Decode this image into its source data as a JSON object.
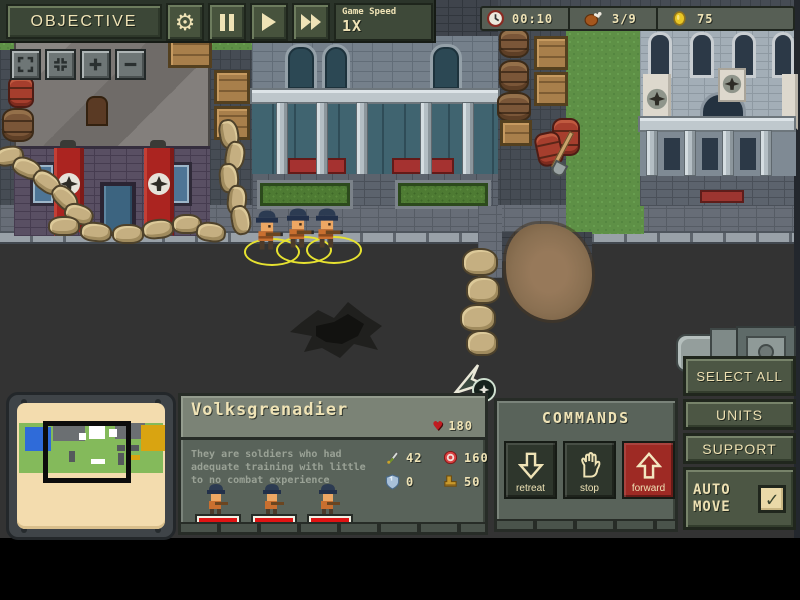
{
  "hud": {
    "objective": "OBJECTIVE",
    "game_speed_label": "Game Speed",
    "game_speed_value": "1X",
    "timer": "00:10",
    "food": "3/9",
    "coins": "75"
  },
  "camera_controls": {
    "icons": [
      "expand-icon",
      "shrink-icon",
      "zoom-in-icon",
      "zoom-out-icon"
    ]
  },
  "unit_panel": {
    "title": "Volksgrenadier",
    "hp": "180",
    "description": "They are soldiers who had adequate training with little to no combat experience",
    "attack": "42",
    "range": "160",
    "armor": "0",
    "speed": "50",
    "unit_count": 3
  },
  "commands": {
    "title": "COMMANDS",
    "retreat": "retreat",
    "stop": "stop",
    "forward": "forward"
  },
  "side": {
    "select_all": "SELECT ALL",
    "units": "UNITS",
    "support": "SUPPORT",
    "auto_move": "AUTO MOVE",
    "auto_move_checked": true,
    "check_glyph": "✓"
  },
  "icons": {
    "settings": "gear-icon",
    "pause": "pause-icon",
    "play": "play-icon",
    "fast_forward": "fast-forward-icon",
    "timer": "clock-icon",
    "food": "drumstick-icon",
    "money": "coin-icon",
    "hp": "heart-icon",
    "attack": "sword-icon",
    "range": "target-icon",
    "armor": "shield-icon",
    "speed": "boot-icon"
  },
  "colors": {
    "cream_text": "#efe3b6",
    "olive_button": "#47533d",
    "panel": "#59635a",
    "banner_red": "#ab2420",
    "forward_red": "#9e2a24",
    "road": "#333333",
    "grass": "#5e9046",
    "sandbag": "#c5af81",
    "minimap_paper": "#f3dcae",
    "minimap_terrain": "#84ba5b",
    "minimap_water": "#2f6bd9",
    "minimap_gold": "#d9a411",
    "health_red": "#e01313",
    "selection_yellow": "#e6e230"
  }
}
